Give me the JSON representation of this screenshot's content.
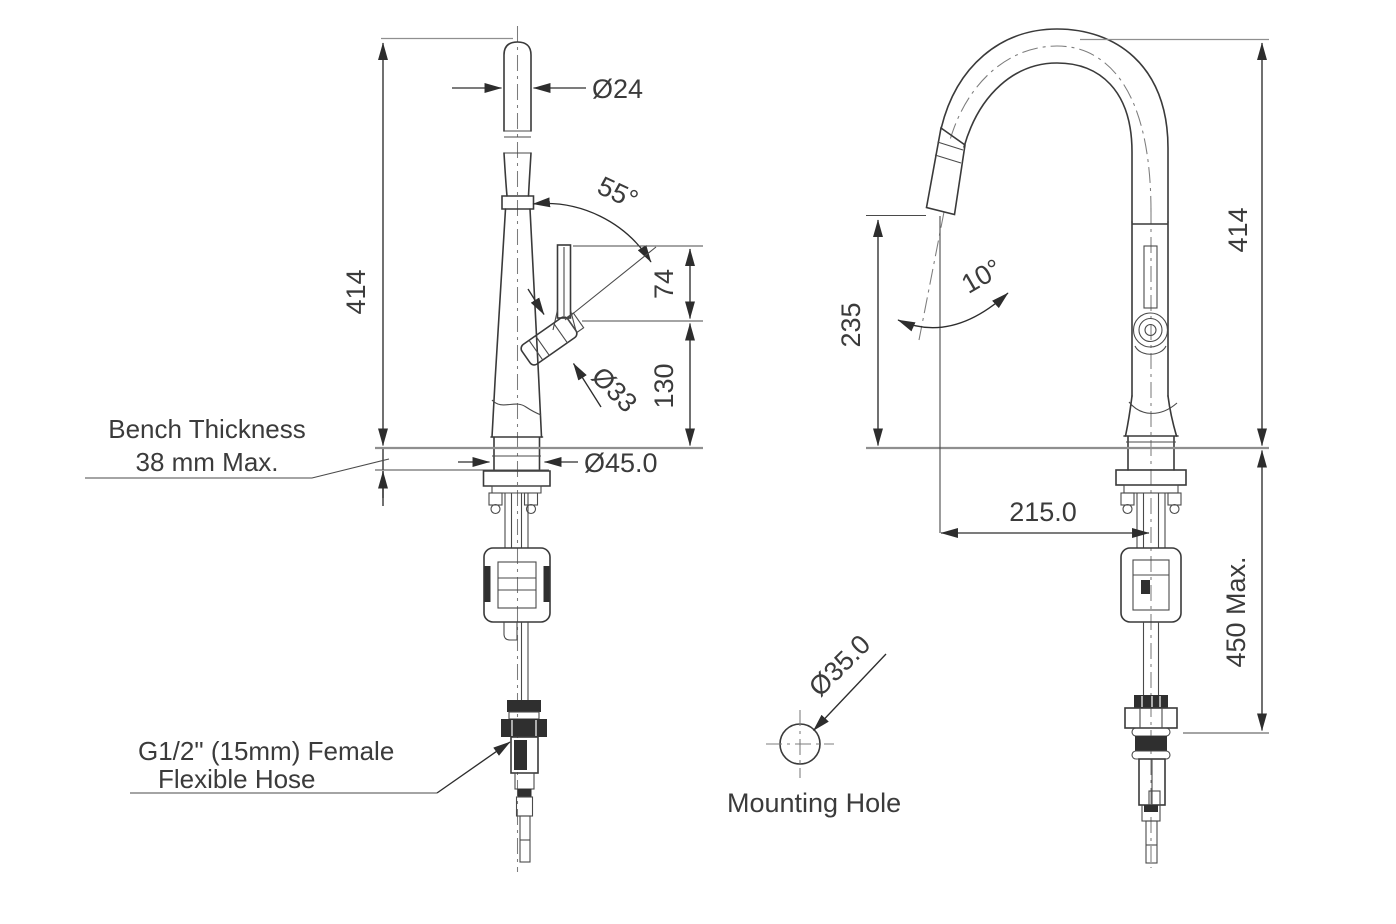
{
  "drawing": {
    "front_view": {
      "spout_diameter": "Ø24",
      "handle_swing_angle": "55°",
      "height_above_bench": "414",
      "handle_tip_rise": "74",
      "handle_pivot_height": "130",
      "handle_base_diameter": "Ø33",
      "base_diameter": "Ø45.0",
      "bench_note": {
        "line1": "Bench Thickness",
        "line2": "38 mm Max."
      },
      "hose_note": {
        "line1": "G1/2\" (15mm) Female",
        "line2": "Flexible Hose"
      }
    },
    "side_view": {
      "height_above_bench": "414",
      "spout_outlet_height": "235",
      "spray_head_angle": "10°",
      "spout_reach": "215.0",
      "under_bench_clearance": "450 Max."
    },
    "mounting_hole": {
      "diameter": "Ø35.0",
      "label": "Mounting Hole"
    },
    "colors": {
      "outline": "#3a3a3a",
      "dimension": "#2d2d2d",
      "extension": "#8f8f8f",
      "text": "#3b3b3b",
      "background": "#ffffff"
    }
  }
}
